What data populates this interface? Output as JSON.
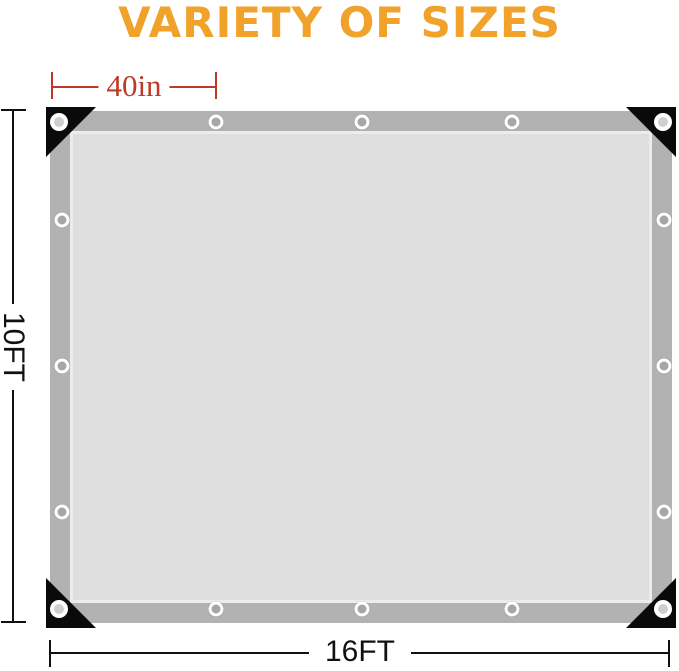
{
  "title": {
    "text": "VARIETY OF SIZES",
    "color": "#F0A22A"
  },
  "dimensions": {
    "grommet_spacing": {
      "label": "40in",
      "color": "#BE3A26"
    },
    "height": {
      "label": "10FT",
      "color": "#111111"
    },
    "width": {
      "label": "16FT",
      "color": "#111111"
    }
  },
  "tarp": {
    "border_color": "#B2B2B2",
    "fill_color": "#DEDEDE",
    "fill_edge_color": "#ECECEC",
    "corner_color": "#0A0A0A",
    "grommet_ring_color": "#FFFFFF",
    "grommet_hole_edge_color": "#A6A6A6",
    "grommet_hole_corner_color": "#CFCFCF",
    "grommet_count": 16,
    "grommets": {
      "corners": [
        [
          59,
          122
        ],
        [
          663,
          122
        ],
        [
          59,
          609
        ],
        [
          663,
          609
        ]
      ],
      "top_edge": [
        [
          216,
          122
        ],
        [
          362,
          122
        ],
        [
          512,
          122
        ]
      ],
      "bottom_edge": [
        [
          216,
          609
        ],
        [
          362,
          609
        ],
        [
          512,
          609
        ]
      ],
      "left_edge": [
        [
          62,
          220
        ],
        [
          62,
          366
        ],
        [
          62,
          512
        ]
      ],
      "right_edge": [
        [
          664,
          220
        ],
        [
          664,
          366
        ],
        [
          664,
          512
        ]
      ]
    }
  }
}
